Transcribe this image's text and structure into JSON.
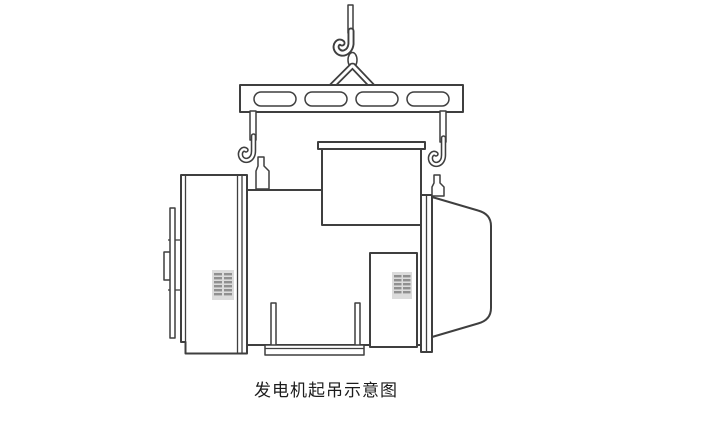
{
  "diagram": {
    "caption": "发电机起吊示意图",
    "colors": {
      "background": "#ffffff",
      "line": "#3f3f3f",
      "fill": "#ffffff",
      "grille_bg": "#dcdcdc",
      "grille_bar": "#909090",
      "caption_text": "#1c1c1c"
    }
  }
}
